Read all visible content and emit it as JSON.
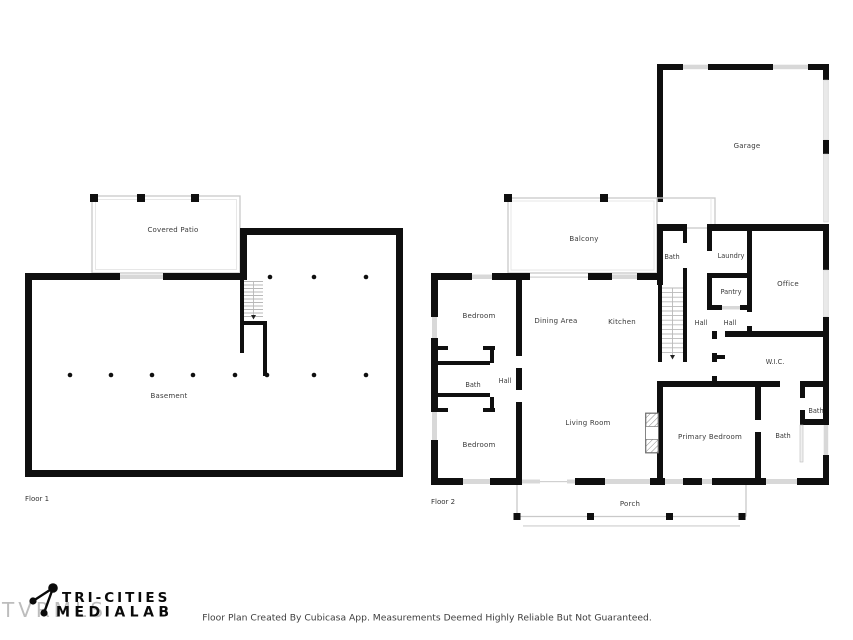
{
  "floor1": {
    "name": "Floor 1",
    "rooms": {
      "covered_patio": "Covered Patio",
      "basement": "Basement"
    }
  },
  "floor2": {
    "name": "Floor 2",
    "rooms": {
      "garage": "Garage",
      "balcony": "Balcony",
      "bath_top": "Bath",
      "laundry": "Laundry",
      "pantry": "Pantry",
      "office": "Office",
      "hall_stairs": "Hall",
      "hall_pantry": "Hall",
      "bedroom_top": "Bedroom",
      "dining_area": "Dining Area",
      "kitchen": "Kitchen",
      "bath_left": "Bath",
      "hall_left": "Hall",
      "bedroom_bottom": "Bedroom",
      "living_room": "Living Room",
      "wic": "W.I.C.",
      "primary_bedroom": "Primary Bedroom",
      "bath_primary": "Bath",
      "bath_small": "Bath",
      "porch": "Porch"
    }
  },
  "footer": {
    "watermark": "TVRMLS",
    "logo_line1": "TRI-CITIES",
    "logo_line2": "MEDIALAB",
    "disclaimer": "Floor Plan Created By Cubicasa App. Measurements Deemed Highly Reliable But Not Guaranteed."
  },
  "colors": {
    "wall": "#0f0f0f",
    "window": "#d8d8d8",
    "porch_outline": "#c9c9c9",
    "label_text": "#3a3a3a"
  }
}
